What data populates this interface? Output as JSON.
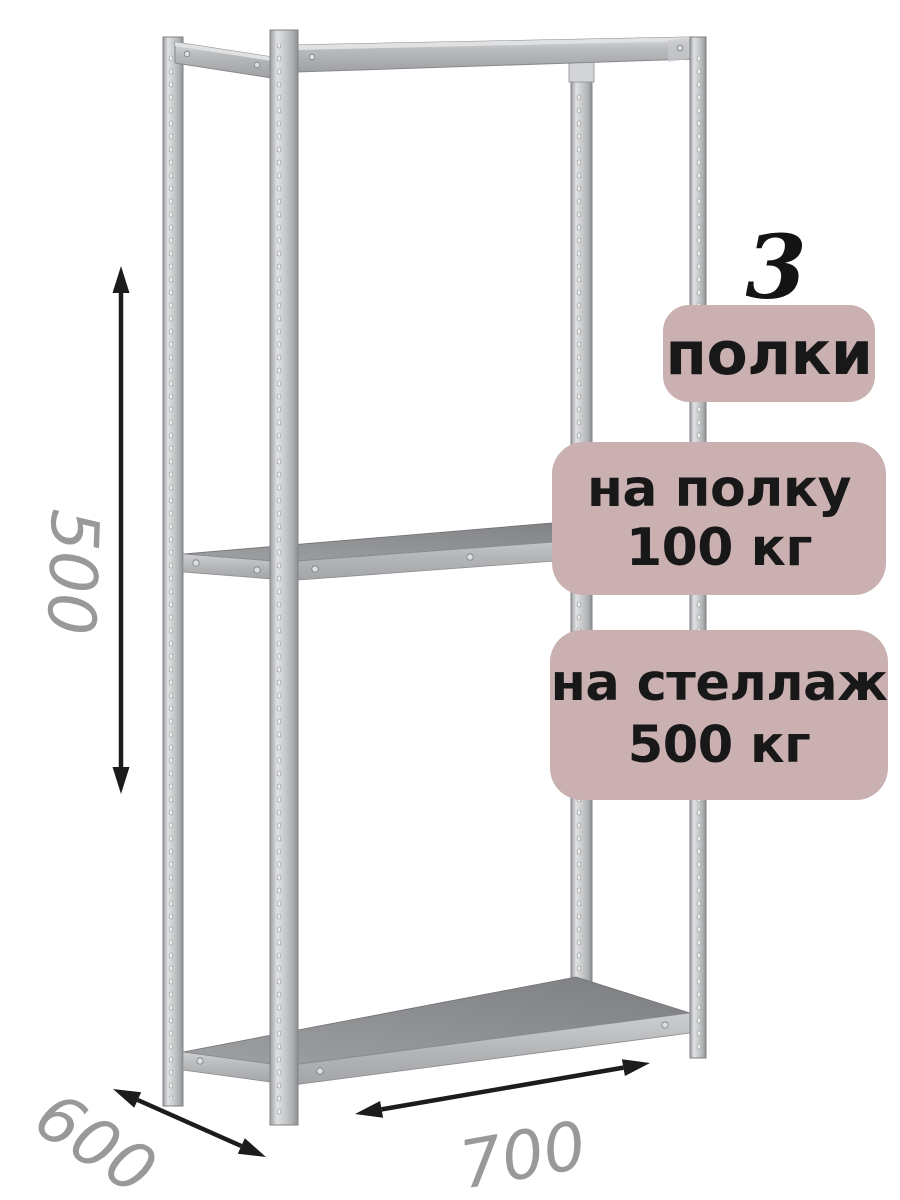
{
  "badges": {
    "count_value": "3",
    "count_label": "полки",
    "per_shelf": {
      "line1": "на полку",
      "line2": "100 кг"
    },
    "per_rack": {
      "line1": "на стеллаж",
      "line2": "500 кг"
    }
  },
  "dimensions": {
    "height": "500",
    "depth": "600",
    "width": "700"
  },
  "colors": {
    "background": "#ffffff",
    "badge_background": "#cab0b0",
    "badge_text": "#181818",
    "dimension_text": "#97999a",
    "arrow": "#1c1c1c",
    "metal_light": "#e0e2e4",
    "metal_mid": "#bfc1c3",
    "metal_dark": "#85878a",
    "shelf_surface": "#87898b"
  }
}
